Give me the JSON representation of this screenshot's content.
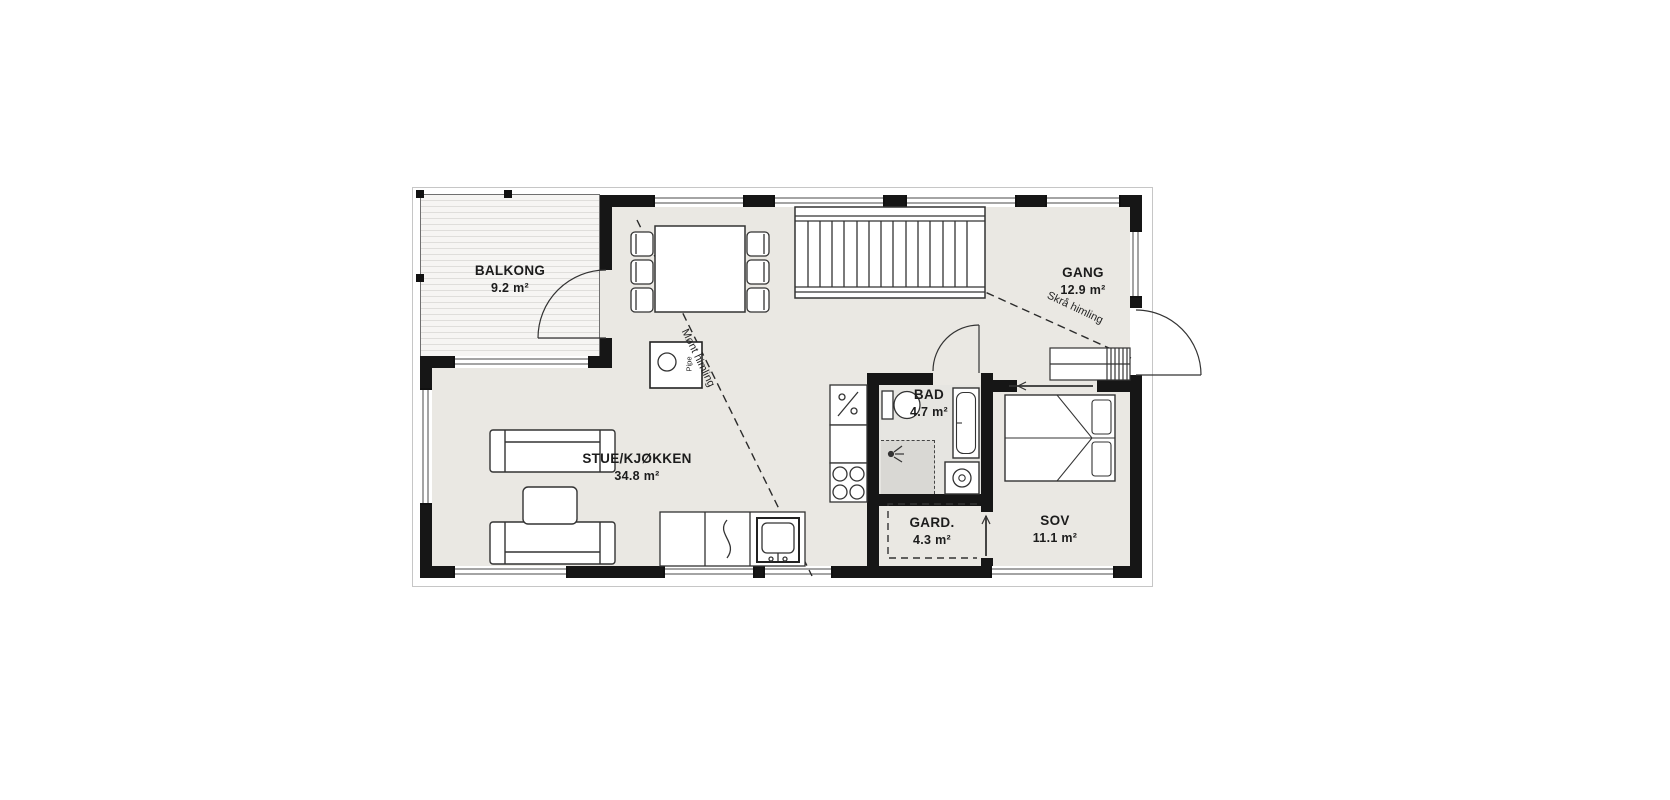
{
  "plan": {
    "rooms": {
      "balkong": {
        "name": "BALKONG",
        "area": "9.2 m²"
      },
      "stue": {
        "name": "STUE/KJØKKEN",
        "area": "34.8 m²"
      },
      "gang": {
        "name": "GANG",
        "area": "12.9 m²"
      },
      "bad": {
        "name": "BAD",
        "area": "4.7 m²"
      },
      "gard": {
        "name": "GARD.",
        "area": "4.3 m²"
      },
      "sov": {
        "name": "SOV",
        "area": "11.1 m²"
      }
    },
    "annotations": {
      "ceiling_ridge": "Mønt himling",
      "ceiling_slope": "Skrå himling",
      "chimney": "Pipe"
    },
    "colors": {
      "wall": "#161616",
      "floor": "#eae8e3",
      "bad_floor": "#e6e5e1",
      "shower_floor": "#d9d8d4",
      "balcony_stripe": "#dfdedb",
      "outline": "#c6c6c6"
    }
  }
}
